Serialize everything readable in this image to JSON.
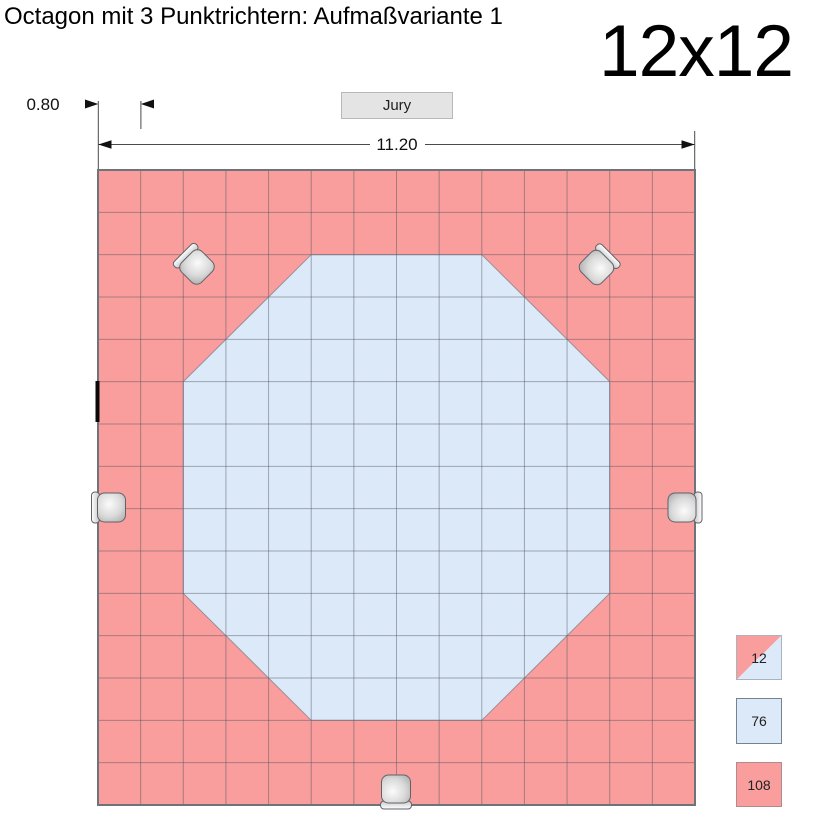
{
  "title": "Octagon mit 3 Punktrichtern: Aufmaßvariante 1",
  "size_label": "12x12",
  "jury_button_label": "Jury",
  "dimensions": {
    "cell_width_label": "0.80",
    "mat_width_label": "11.20"
  },
  "legend": {
    "items": [
      {
        "value": "12",
        "kind": "half-red-half-blue-tile"
      },
      {
        "value": "76",
        "kind": "blue-inner-tile"
      },
      {
        "value": "108",
        "kind": "red-outer-tile"
      }
    ]
  },
  "colors": {
    "tile_red": "#fa9d9d",
    "tile_blue": "#dce9f8",
    "grid_line": "rgba(70,80,90,0.45)",
    "mat_border": "#6e7479",
    "octagon_outline": "rgba(100,110,125,0.6)",
    "dimension_line": "#4a4a4a",
    "seat_outline": "#5f6368"
  },
  "diagram": {
    "grid": {
      "cols": 14,
      "rows": 15,
      "x": 98,
      "y": 170,
      "width": 597,
      "height": 635
    },
    "octagon_cells": [
      [
        5,
        2
      ],
      [
        9,
        2
      ],
      [
        12,
        5
      ],
      [
        12,
        10
      ],
      [
        9,
        13
      ],
      [
        5,
        13
      ],
      [
        2,
        10
      ],
      [
        2,
        5
      ]
    ],
    "seats": [
      {
        "name": "seat-top-left",
        "x": 197,
        "y": 267,
        "rotation": 45
      },
      {
        "name": "seat-top-right",
        "x": 596.5,
        "y": 267.5,
        "rotation": 135
      },
      {
        "name": "seat-left",
        "x": 111.5,
        "y": 507.5,
        "rotation": 0
      },
      {
        "name": "seat-right",
        "x": 682,
        "y": 507.5,
        "rotation": 180
      },
      {
        "name": "seat-bottom",
        "x": 396,
        "y": 789,
        "rotation": -90
      }
    ]
  }
}
